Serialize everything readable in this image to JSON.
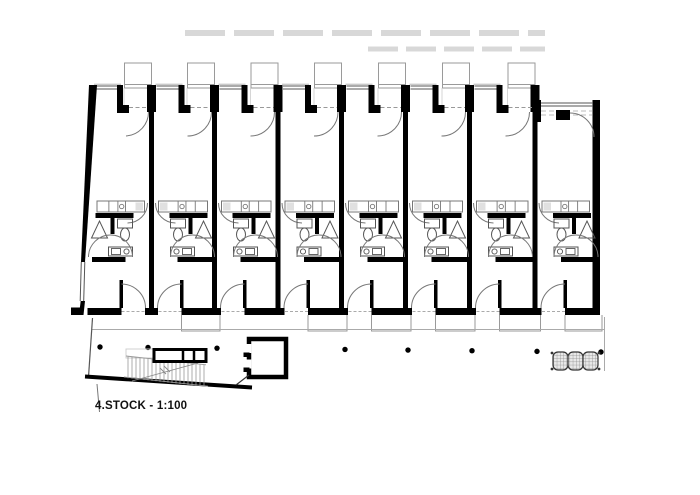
{
  "title": {
    "label": "4.STOCK - 1:100",
    "floor": "4.STOCK",
    "drawing_scale": "1:100"
  },
  "canvas": {
    "width": 700,
    "height": 495,
    "background": "#ffffff"
  },
  "colors": {
    "wall": "#000000",
    "line": "#555555",
    "fixture": "#555555",
    "arc": "#777777",
    "light": "#9a9a9a",
    "faint": "#d8d8d8",
    "balcony": "#9a9a9a",
    "hatch": "#888888",
    "hatch_bg": "#e8e8e8"
  },
  "plan": {
    "units_count": 8,
    "mirrored_units": [
      0
    ],
    "no_top_balcony_units": [
      7
    ],
    "bottom_balcony_units": [
      1,
      3,
      4,
      5,
      6,
      7
    ],
    "walls_x": [
      90,
      151.5,
      214.5,
      278,
      341.5,
      405.5,
      469.5,
      535,
      596.5
    ],
    "top": {
      "wall_y": 85,
      "stub_h": 27,
      "window_y1": 86,
      "window_y2": 89,
      "lintel_y": 107.5,
      "balcony_y": 63,
      "balcony_h": 25,
      "balcony_w": 27
    },
    "unit8_top": {
      "wall_y": 100,
      "corner_h": 22,
      "glass_y1": 103,
      "glass_y2": 106,
      "dash_y1": 111,
      "dash_y2": 115,
      "duct": [
        556,
        110,
        14,
        10
      ]
    },
    "kitchen": {
      "y": 201,
      "h": 11
    },
    "wall1_y": 213,
    "bath": {
      "wall2_y": 257
    },
    "partition": {
      "off": 28.5,
      "y": 280,
      "h": 28,
      "w": 3.5
    },
    "bottom": {
      "wall_y": 308,
      "t": 7
    },
    "balcony_bottom": {
      "y": 315,
      "bot": 331,
      "off": 30,
      "over": 5.5
    },
    "left_wall": {
      "window_y1": 262,
      "window_y2": 301
    },
    "faint_rows": [
      {
        "y": 33,
        "x1": 185,
        "x2": 545,
        "w": 6,
        "dash": "40 9"
      },
      {
        "y": 49,
        "x1": 368,
        "x2": 545,
        "w": 5,
        "dash": "30 8"
      }
    ]
  },
  "site": {
    "walkway": {
      "y": 329.5,
      "x1": 92,
      "x2": 604,
      "right_jog_top": 317,
      "right_x": 604.5,
      "right_y2": 371
    },
    "columns": {
      "xs": [
        100,
        148,
        217,
        345,
        408,
        472,
        537,
        601
      ],
      "base_y": 347,
      "slope": 0.01,
      "r": 2.7
    },
    "edge": {
      "x1": 85,
      "y1": 376.5,
      "x2": 252,
      "y2": 387.5,
      "t": 4
    },
    "left_line": {
      "x1": 92.5,
      "y1": 318,
      "x2": 88.5,
      "y2": 377
    },
    "tail": {
      "x1": 97,
      "y1": 384,
      "x2": 99.5,
      "y2": 412
    },
    "stair": {
      "x1": 126,
      "x2": 206,
      "top_y": 356,
      "bot_y": 377,
      "slope": 0.11,
      "step": 4,
      "flight": {
        "x": 154,
        "y": 349.5,
        "w": 52,
        "h": 12,
        "dividers": [
          183,
          194
        ]
      },
      "arrow": {
        "x1": 132,
        "y1": 381,
        "x2": 198,
        "y2": 363
      },
      "ghost": {
        "x": 126,
        "y": 349,
        "w": 30,
        "h": 9
      }
    },
    "elevator": {
      "x": 249,
      "y": 339,
      "w": 37,
      "h": 38,
      "t": 4.5
    },
    "bike_rack": {
      "x": 553,
      "y": 352,
      "w": 45,
      "h": 18,
      "modules": 3
    }
  }
}
